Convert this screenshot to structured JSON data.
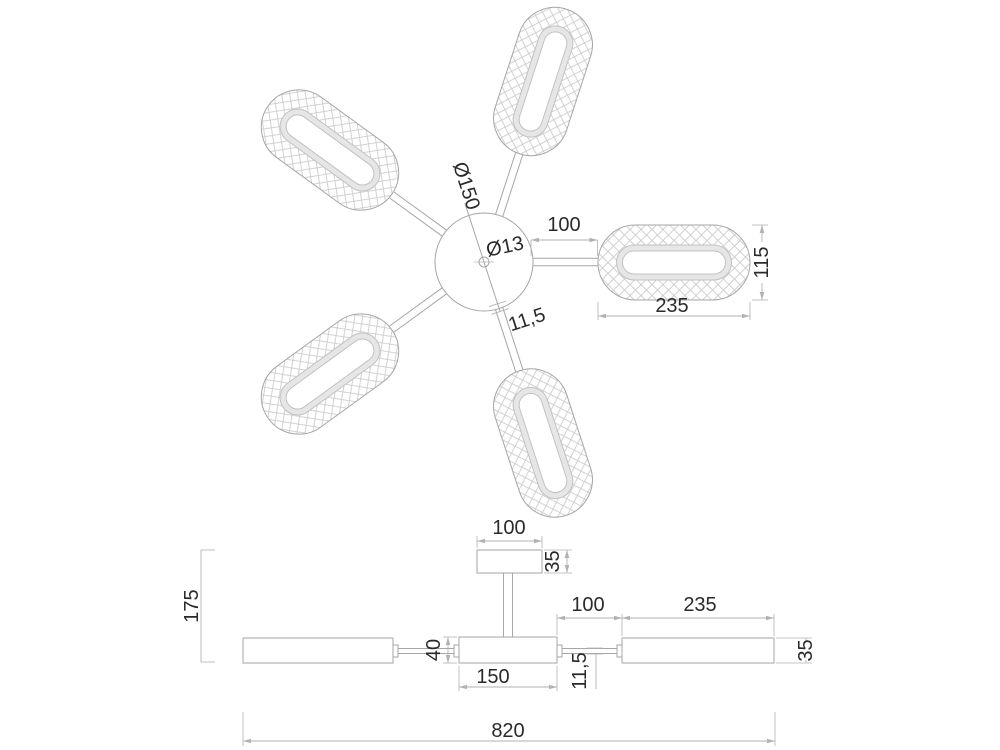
{
  "top_view": {
    "hub_diameter_label": "Ø150",
    "hole_diameter_label": "Ø13",
    "arm_length_label": "100",
    "arm_width_label": "11,5",
    "shade_length_label": "235",
    "shade_width_label": "115"
  },
  "side_view": {
    "canopy_width_label": "100",
    "canopy_height_label": "35",
    "overall_height_label": "175",
    "body_height_label": "40",
    "body_width_label": "150",
    "arm_length_label": "100",
    "arm_width_label": "11,5",
    "shade_length_label": "235",
    "shade_height_label": "35",
    "overall_width_label": "820"
  },
  "colors": {
    "background": "#ffffff",
    "geometry": "#a6a6a6",
    "hatch": "#cccccc",
    "band-fill": "#e6e6e6",
    "band-stroke": "#c2c2c2",
    "dimension": "#b2b2b2",
    "text": "#2a2a2a"
  }
}
